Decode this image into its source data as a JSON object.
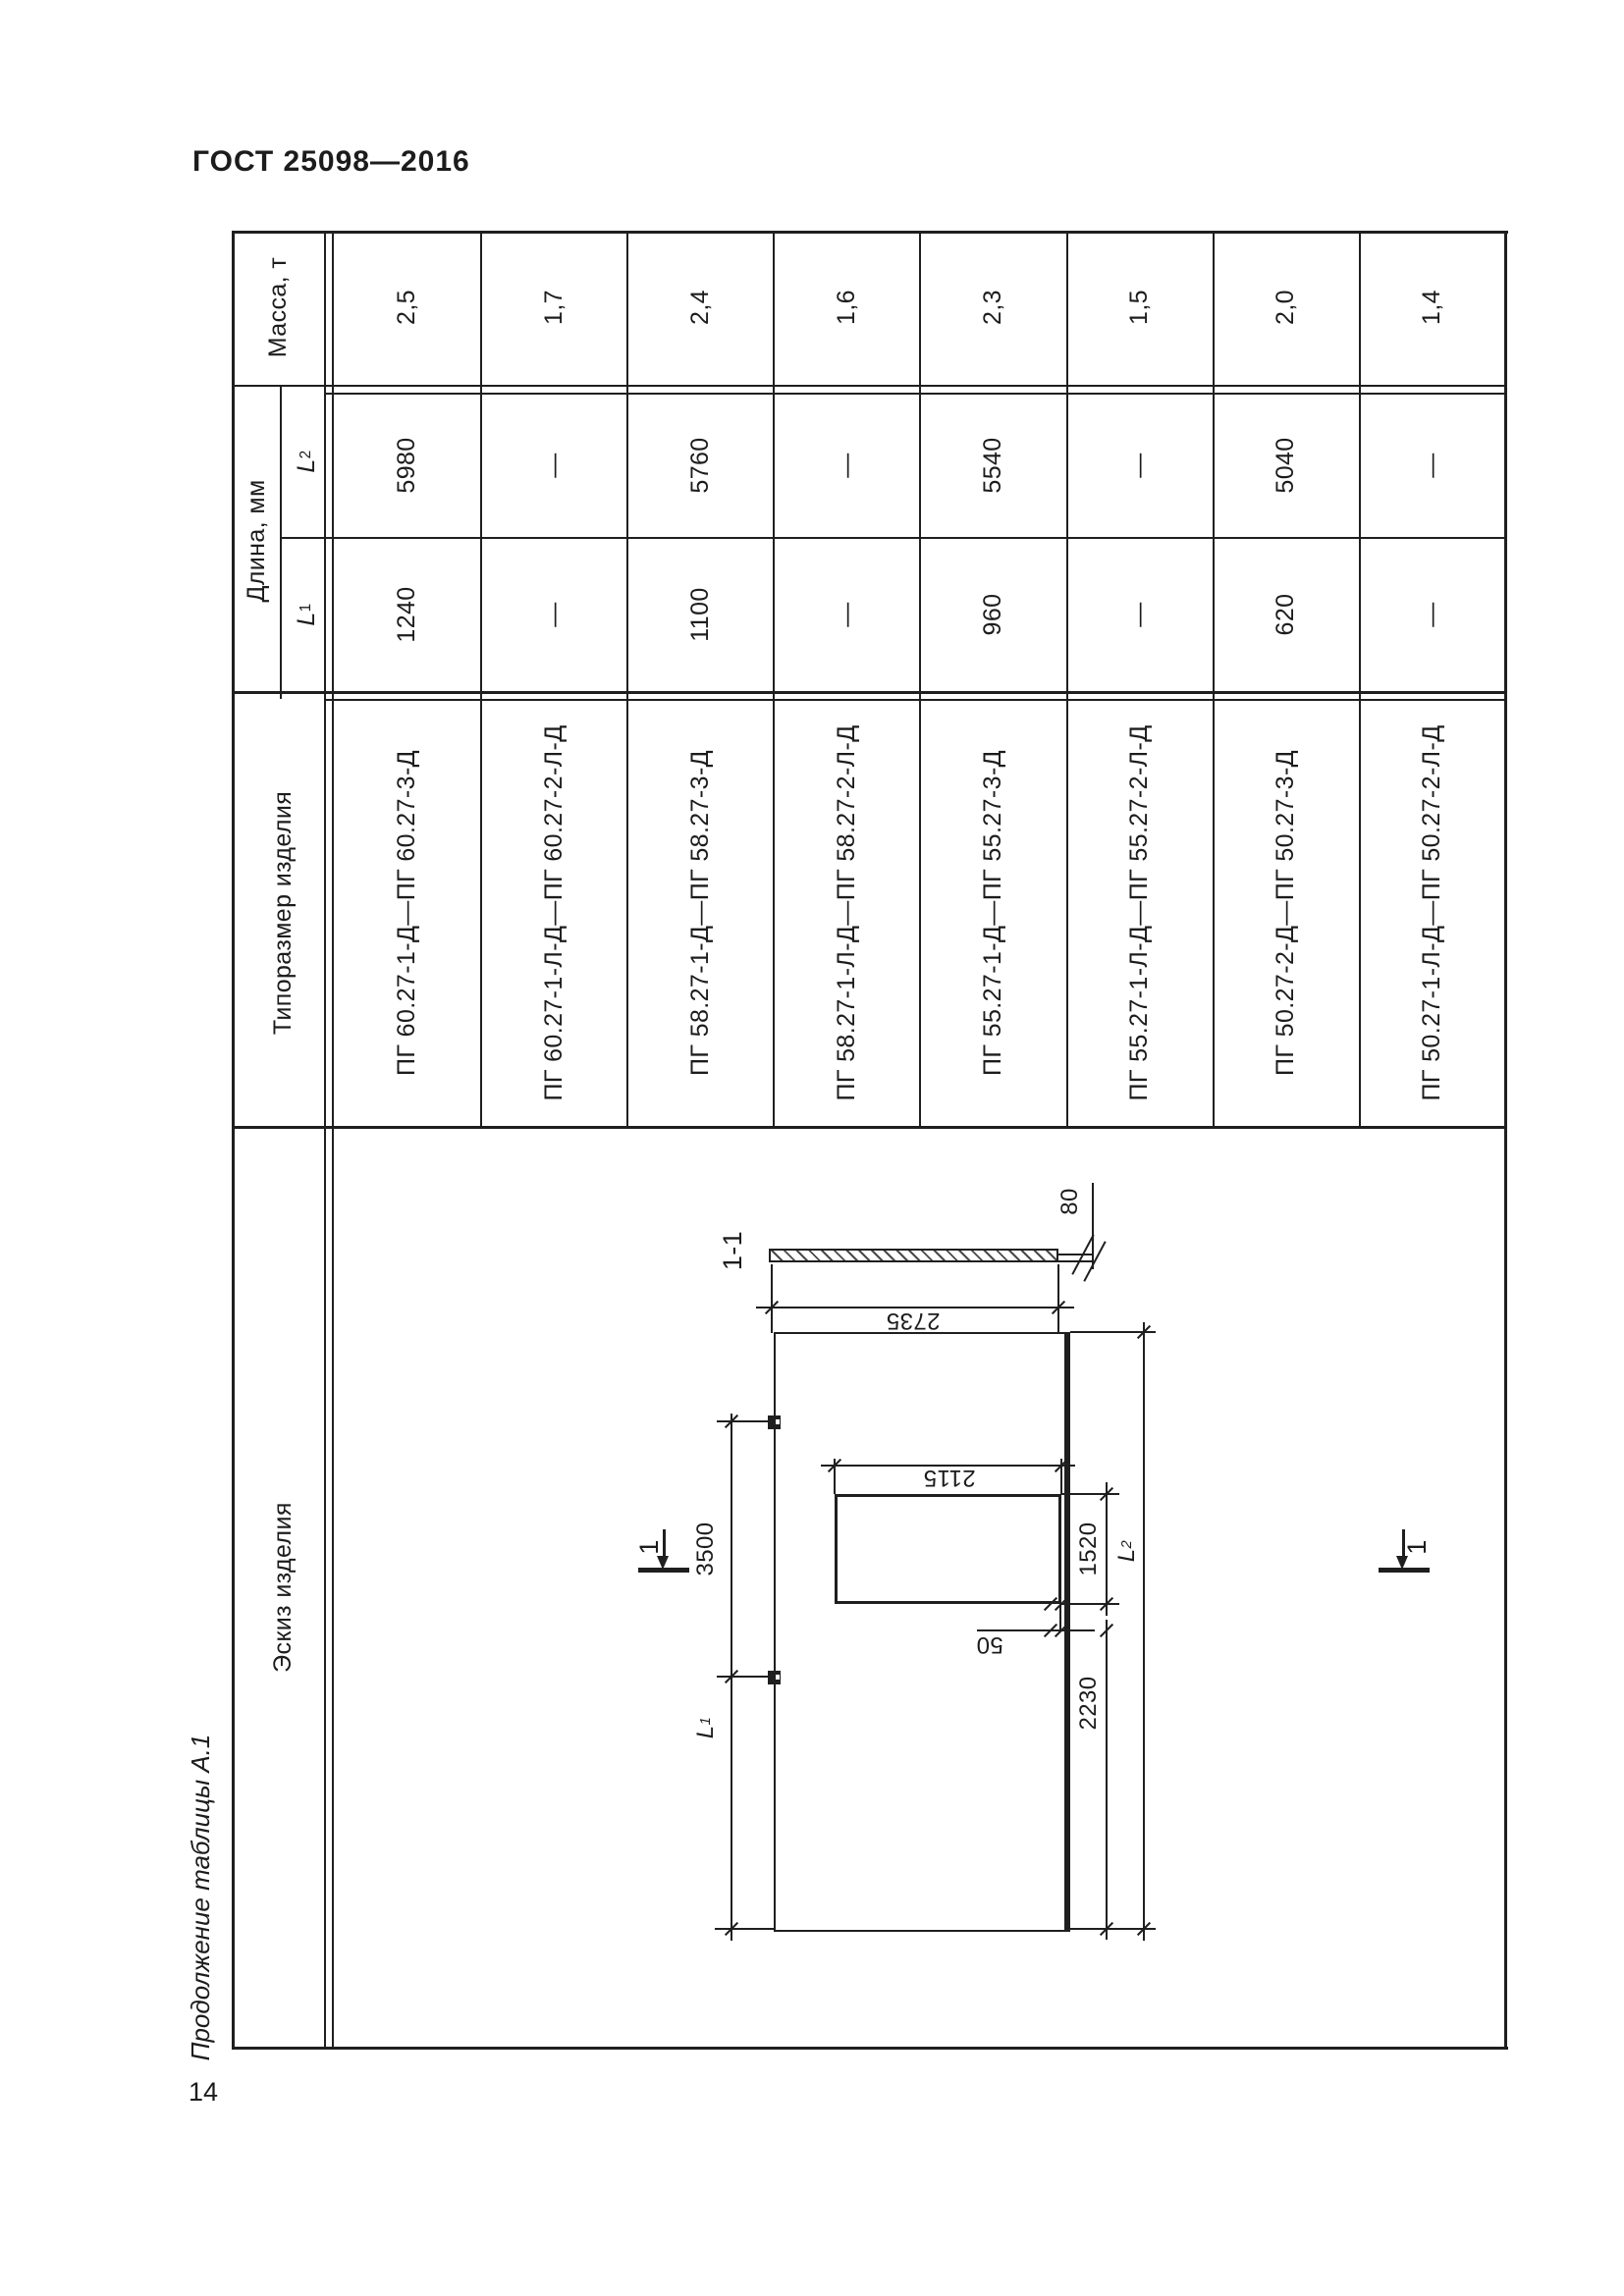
{
  "page": {
    "standard": "ГОСТ 25098—2016",
    "caption": "Продолжение таблицы А.1",
    "number": "14"
  },
  "table": {
    "headers": {
      "mass": "Масса, т",
      "length": "Длина, мм",
      "len_symbol": "L",
      "l1_sub": "1",
      "l2_sub": "2",
      "type": "Типоразмер изделия",
      "sketch": "Эскиз изделия"
    },
    "columns": [
      {
        "type": "ПГ 60.27-1-Д—ПГ 60.27-3-Д",
        "l1": "1240",
        "l2": "5980",
        "mass": "2,5"
      },
      {
        "type": "ПГ 60.27-1-Л-Д—ПГ 60.27-2-Л-Д",
        "l1": "—",
        "l2": "—",
        "mass": "1,7"
      },
      {
        "type": "ПГ 58.27-1-Д—ПГ 58.27-3-Д",
        "l1": "1100",
        "l2": "5760",
        "mass": "2,4"
      },
      {
        "type": "ПГ 58.27-1-Л-Д—ПГ 58.27-2-Л-Д",
        "l1": "—",
        "l2": "—",
        "mass": "1,6"
      },
      {
        "type": "ПГ 55.27-1-Д—ПГ 55.27-3-Д",
        "l1": "960",
        "l2": "5540",
        "mass": "2,3"
      },
      {
        "type": "ПГ 55.27-1-Л-Д—ПГ 55.27-2-Л-Д",
        "l1": "—",
        "l2": "—",
        "mass": "1,5"
      },
      {
        "type": "ПГ 50.27-2-Д—ПГ 50.27-3-Д",
        "l1": "620",
        "l2": "5040",
        "mass": "2,0"
      },
      {
        "type": "ПГ 50.27-1-Л-Д—ПГ 50.27-2-Л-Д",
        "l1": "—",
        "l2": "—",
        "mass": "1,4"
      }
    ]
  },
  "drawing": {
    "section_view_label": "1-1",
    "cut_mark_label": "1",
    "dims": {
      "panel_width": "2735",
      "panel_thickness": "80",
      "opening_width": "2115",
      "opening_length": "1520",
      "loop_spacing": "3500",
      "end_length": "2230",
      "edge_offset": "50"
    },
    "sym": {
      "L": "L",
      "sub1": "1",
      "sub2": "2"
    }
  }
}
